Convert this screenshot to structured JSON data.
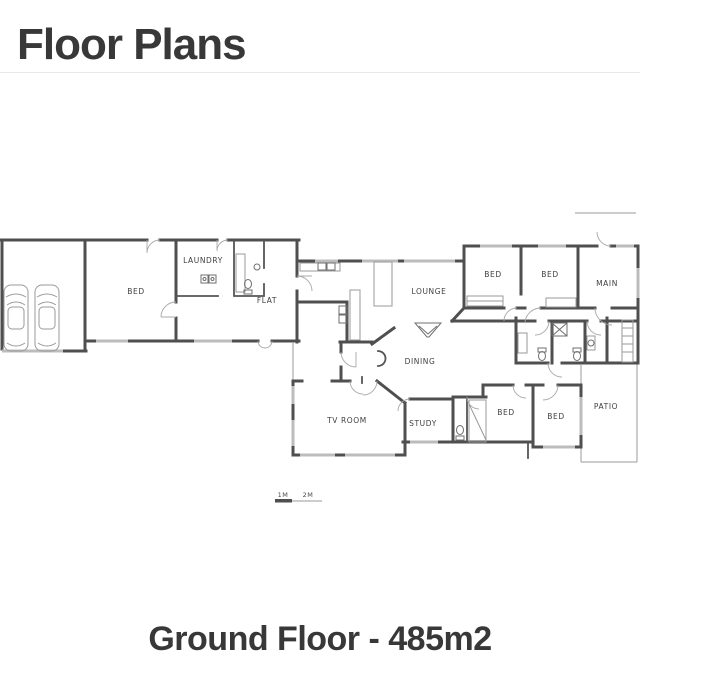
{
  "page": {
    "title": "Floor Plans"
  },
  "floor_plan": {
    "caption": "Ground Floor - 485m2",
    "scale": {
      "mark1": "1M",
      "mark2": "2M"
    },
    "rooms": [
      {
        "label": "BED"
      },
      {
        "label": "LAUNDRY"
      },
      {
        "label": "FLAT"
      },
      {
        "label": "LOUNGE"
      },
      {
        "label": "BED"
      },
      {
        "label": "BED"
      },
      {
        "label": "MAIN"
      },
      {
        "label": "DINING"
      },
      {
        "label": "TV ROOM"
      },
      {
        "label": "STUDY"
      },
      {
        "label": "BED"
      },
      {
        "label": "BED"
      },
      {
        "label": "PATIO"
      }
    ],
    "colors": {
      "wall": "#4f4f4f",
      "window": "#bcbcbc",
      "label_text": "#3f3f3f",
      "heading_text": "#383838",
      "divider": "#e9e9e9"
    }
  }
}
